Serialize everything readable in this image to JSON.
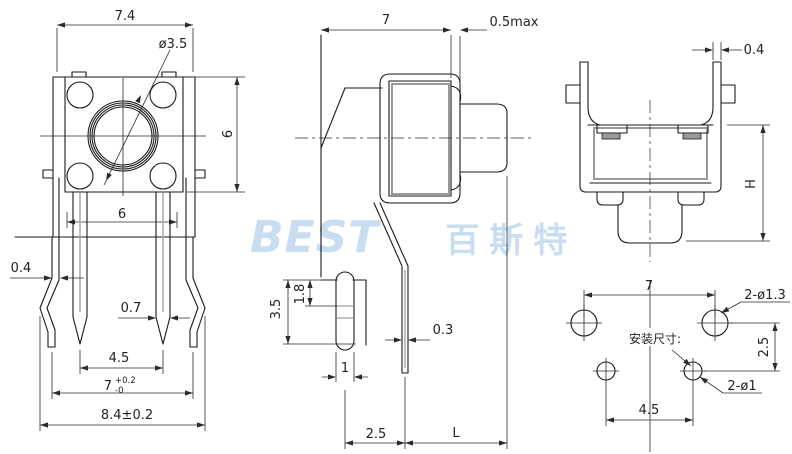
{
  "watermark": {
    "latin": "BEST",
    "cjk": "百斯特",
    "color": "#c9ddf1"
  },
  "top_view": {
    "dim_overall_width": "7.4",
    "dim_button_diameter": "ø3.5",
    "dim_body_height": "6",
    "dim_pin_row_span": "6"
  },
  "pin_detail": {
    "dim_bracket_leg_thickness": "0.4",
    "dim_pin_width": "0.7",
    "dim_pin_pitch": "4.5",
    "dim_leg_pitch": "7",
    "dim_leg_pitch_tol_upper": "+0.2",
    "dim_leg_pitch_tol_lower": "-0",
    "dim_overall_span": "8.4±0.2"
  },
  "side_view": {
    "dim_body_depth": "7",
    "dim_gap": "0.5max",
    "dim_foot_depth": "3.5",
    "dim_board_offset": "1.8",
    "dim_pin_thickness": "0.3",
    "dim_peg_width": "1",
    "dim_peg_to_pin": "2.5",
    "dim_pin_length": "L"
  },
  "front_view": {
    "dim_arm_thickness": "0.4",
    "dim_height": "H"
  },
  "mounting_layout": {
    "title": "安装尺寸:",
    "dim_hole_span": "7",
    "dim_top_holes": "2-ø1.3",
    "dim_row_gap": "2.5",
    "dim_bottom_holes": "2-ø1",
    "dim_bottom_span": "4.5"
  }
}
